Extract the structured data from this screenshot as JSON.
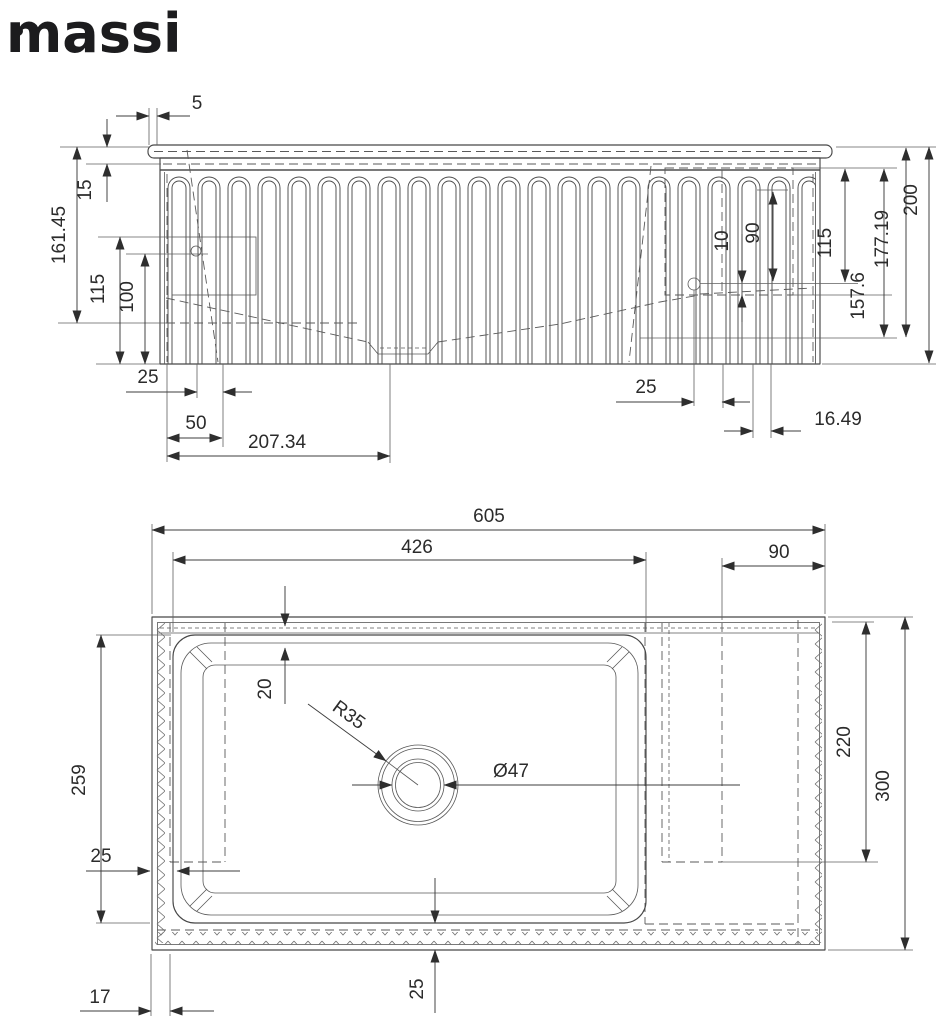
{
  "logo": {
    "text": "massi"
  },
  "colors": {
    "line": "#474747",
    "dim_text": "#2b2b2b",
    "background": "#ffffff"
  },
  "front_view": {
    "dims": {
      "lip5": "5",
      "rim15": "15",
      "h16145": "161.45",
      "l115": "115",
      "l100": "100",
      "b25l": "25",
      "b50": "50",
      "b20734": "207.34",
      "b25r": "25",
      "b1649": "16.49",
      "r10": "10",
      "r90": "90",
      "r115": "115",
      "r1576": "157.6",
      "r17719": "177.19",
      "r200": "200"
    }
  },
  "plan_view": {
    "dims": {
      "w605": "605",
      "w426": "426",
      "w90": "90",
      "rim20": "20",
      "r35": "R35",
      "d47": "Ø47",
      "l259": "259",
      "l25": "25",
      "r220": "220",
      "r300": "300",
      "b17": "17",
      "b25": "25"
    }
  }
}
